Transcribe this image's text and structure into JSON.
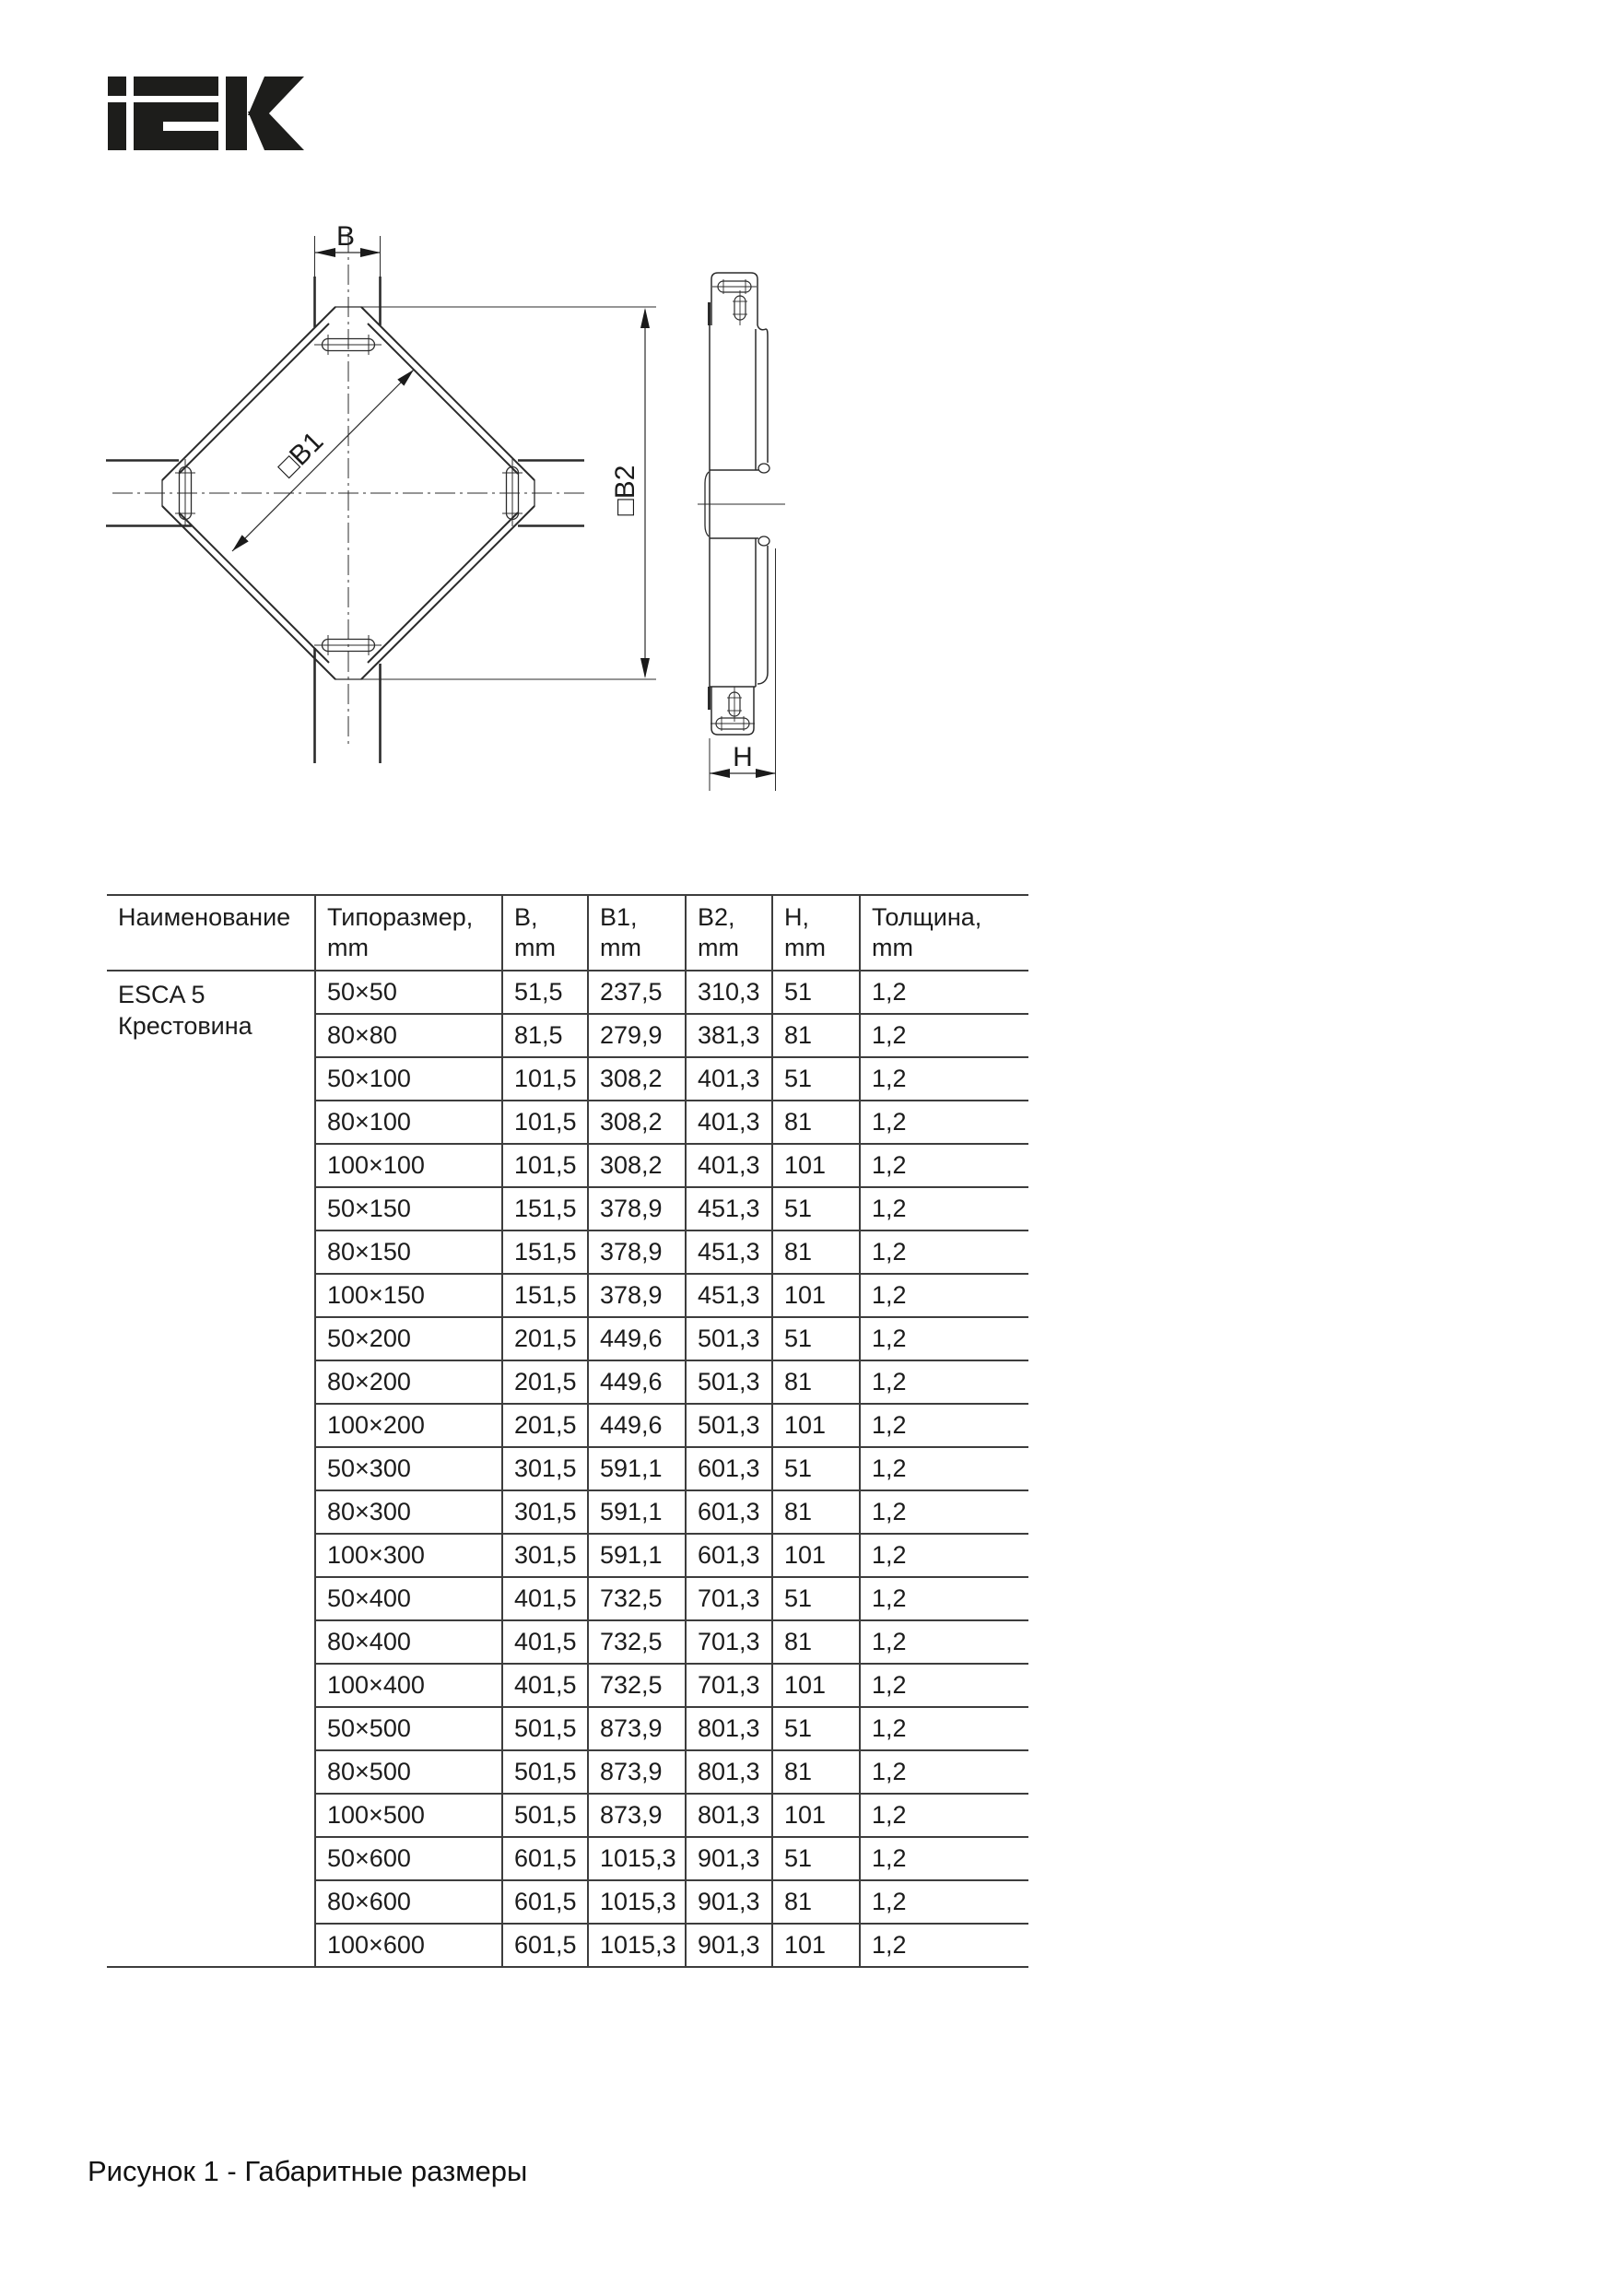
{
  "logo": {
    "text": "iEK",
    "color": "#1d1d1b"
  },
  "drawing": {
    "b_label": "B",
    "b1_label": "□B1",
    "b2_label": "□B2",
    "h_label": "H",
    "line_color": "#2b2b2b"
  },
  "table": {
    "headers": [
      {
        "l1": "Наименование",
        "l2": ""
      },
      {
        "l1": "Типоразмер,",
        "l2": "mm"
      },
      {
        "l1": "B,",
        "l2": "mm"
      },
      {
        "l1": "B1,",
        "l2": "mm"
      },
      {
        "l1": "B2,",
        "l2": "mm"
      },
      {
        "l1": "H,",
        "l2": "mm"
      },
      {
        "l1": "Толщина,",
        "l2": "mm"
      }
    ],
    "product_name": [
      "ESCA 5",
      "Крестовина"
    ],
    "rows": [
      {
        "size": "50×50",
        "b": "51,5",
        "b1": "237,5",
        "b2": "310,3",
        "h": "51",
        "t": "1,2"
      },
      {
        "size": "80×80",
        "b": "81,5",
        "b1": "279,9",
        "b2": "381,3",
        "h": "81",
        "t": "1,2"
      },
      {
        "size": "50×100",
        "b": "101,5",
        "b1": "308,2",
        "b2": "401,3",
        "h": "51",
        "t": "1,2"
      },
      {
        "size": "80×100",
        "b": "101,5",
        "b1": "308,2",
        "b2": "401,3",
        "h": "81",
        "t": "1,2"
      },
      {
        "size": "100×100",
        "b": "101,5",
        "b1": "308,2",
        "b2": "401,3",
        "h": "101",
        "t": "1,2"
      },
      {
        "size": "50×150",
        "b": "151,5",
        "b1": "378,9",
        "b2": "451,3",
        "h": "51",
        "t": "1,2"
      },
      {
        "size": "80×150",
        "b": "151,5",
        "b1": "378,9",
        "b2": "451,3",
        "h": "81",
        "t": "1,2"
      },
      {
        "size": "100×150",
        "b": "151,5",
        "b1": "378,9",
        "b2": "451,3",
        "h": "101",
        "t": "1,2"
      },
      {
        "size": "50×200",
        "b": "201,5",
        "b1": "449,6",
        "b2": "501,3",
        "h": "51",
        "t": "1,2"
      },
      {
        "size": "80×200",
        "b": "201,5",
        "b1": "449,6",
        "b2": "501,3",
        "h": "81",
        "t": "1,2"
      },
      {
        "size": "100×200",
        "b": "201,5",
        "b1": "449,6",
        "b2": "501,3",
        "h": "101",
        "t": "1,2"
      },
      {
        "size": "50×300",
        "b": "301,5",
        "b1": "591,1",
        "b2": "601,3",
        "h": "51",
        "t": "1,2"
      },
      {
        "size": "80×300",
        "b": "301,5",
        "b1": "591,1",
        "b2": "601,3",
        "h": "81",
        "t": "1,2"
      },
      {
        "size": "100×300",
        "b": "301,5",
        "b1": "591,1",
        "b2": "601,3",
        "h": "101",
        "t": "1,2"
      },
      {
        "size": "50×400",
        "b": "401,5",
        "b1": "732,5",
        "b2": "701,3",
        "h": "51",
        "t": "1,2"
      },
      {
        "size": "80×400",
        "b": "401,5",
        "b1": "732,5",
        "b2": "701,3",
        "h": "81",
        "t": "1,2"
      },
      {
        "size": "100×400",
        "b": "401,5",
        "b1": "732,5",
        "b2": "701,3",
        "h": "101",
        "t": "1,2"
      },
      {
        "size": "50×500",
        "b": "501,5",
        "b1": "873,9",
        "b2": "801,3",
        "h": "51",
        "t": "1,2"
      },
      {
        "size": "80×500",
        "b": "501,5",
        "b1": "873,9",
        "b2": "801,3",
        "h": "81",
        "t": "1,2"
      },
      {
        "size": "100×500",
        "b": "501,5",
        "b1": "873,9",
        "b2": "801,3",
        "h": "101",
        "t": "1,2"
      },
      {
        "size": "50×600",
        "b": "601,5",
        "b1": "1015,3",
        "b2": "901,3",
        "h": "51",
        "t": "1,2"
      },
      {
        "size": "80×600",
        "b": "601,5",
        "b1": "1015,3",
        "b2": "901,3",
        "h": "81",
        "t": "1,2"
      },
      {
        "size": "100×600",
        "b": "601,5",
        "b1": "1015,3",
        "b2": "901,3",
        "h": "101",
        "t": "1,2"
      }
    ]
  },
  "caption": "Рисунок 1 - Габаритные размеры"
}
